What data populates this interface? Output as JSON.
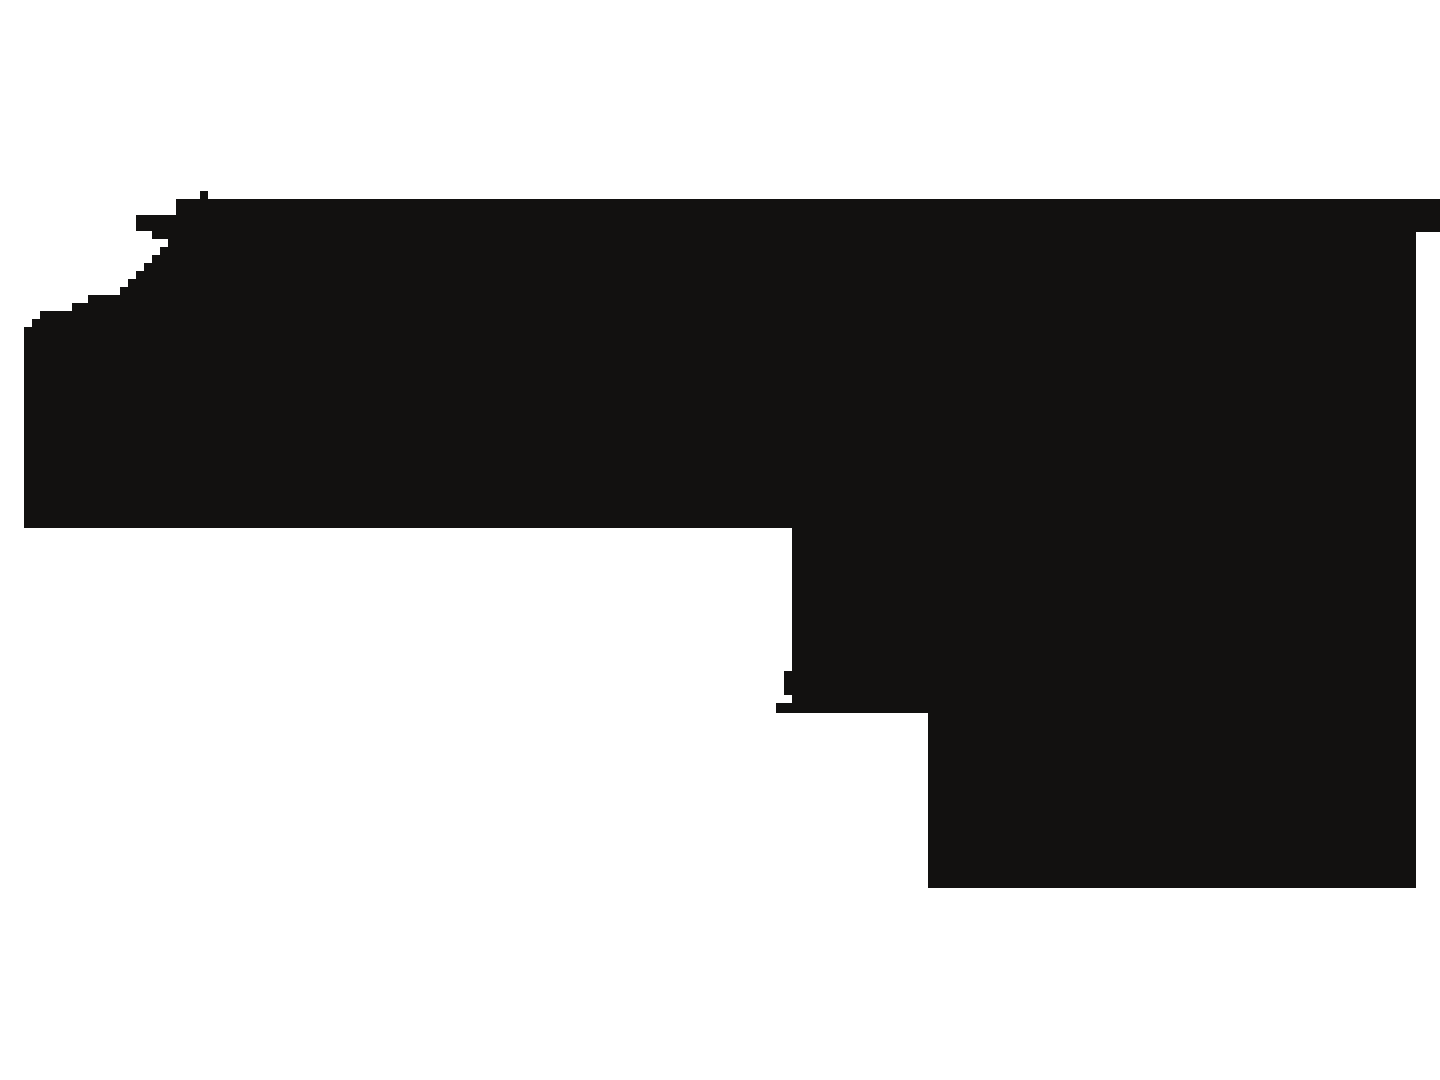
{
  "image": {
    "description": "Blocky pixelated black silhouette of a left-facing handgun-like shape on a plain white background: flat top edge with a small rectangular bump, jagged stair-stepped muzzle edge with spike bars at upper left, rear hammer step touching the right image edge, solid frame, small trigger nub protruding below, and a rectangular grip block descending at the lower right",
    "background_color": "#ffffff",
    "silhouette_color": "#121110",
    "canvas_width": 1440,
    "canvas_height": 1080,
    "viewbox": "0 0 1440 1080",
    "polygon_points": [
      [
        176,
        199
      ],
      [
        200,
        199
      ],
      [
        200,
        191
      ],
      [
        208,
        191
      ],
      [
        208,
        199
      ],
      [
        1440,
        199
      ],
      [
        1440,
        232
      ],
      [
        1416,
        232
      ],
      [
        1416,
        888
      ],
      [
        928,
        888
      ],
      [
        928,
        713
      ],
      [
        776,
        713
      ],
      [
        776,
        703
      ],
      [
        792,
        703
      ],
      [
        792,
        695
      ],
      [
        784,
        695
      ],
      [
        784,
        671
      ],
      [
        792,
        671
      ],
      [
        792,
        528
      ],
      [
        24,
        528
      ],
      [
        24,
        327
      ],
      [
        32,
        327
      ],
      [
        32,
        319
      ],
      [
        40,
        319
      ],
      [
        40,
        311
      ],
      [
        72,
        311
      ],
      [
        72,
        303
      ],
      [
        88,
        303
      ],
      [
        88,
        295
      ],
      [
        120,
        295
      ],
      [
        120,
        287
      ],
      [
        128,
        287
      ],
      [
        128,
        279
      ],
      [
        136,
        279
      ],
      [
        136,
        271
      ],
      [
        144,
        271
      ],
      [
        144,
        263
      ],
      [
        152,
        263
      ],
      [
        152,
        255
      ],
      [
        160,
        255
      ],
      [
        160,
        247
      ],
      [
        168,
        247
      ],
      [
        168,
        239
      ],
      [
        152,
        239
      ],
      [
        152,
        231
      ],
      [
        136,
        231
      ],
      [
        136,
        215
      ],
      [
        176,
        215
      ]
    ],
    "polygon_points_attr": "176,199 200,199 200,191 208,191 208,199 1440,199 1440,232 1416,232 1416,888 928,888 928,713 776,713 776,703 792,703 792,695 784,695 784,671 792,671 792,528 24,528 24,327 32,327 32,319 40,319 40,311 72,311 72,303 88,303 88,295 120,295 120,287 128,287 128,279 136,279 136,271 144,271 144,263 152,263 152,255 160,255 160,247 168,247 168,239 152,239 152,231 136,231 136,215 176,215"
  }
}
